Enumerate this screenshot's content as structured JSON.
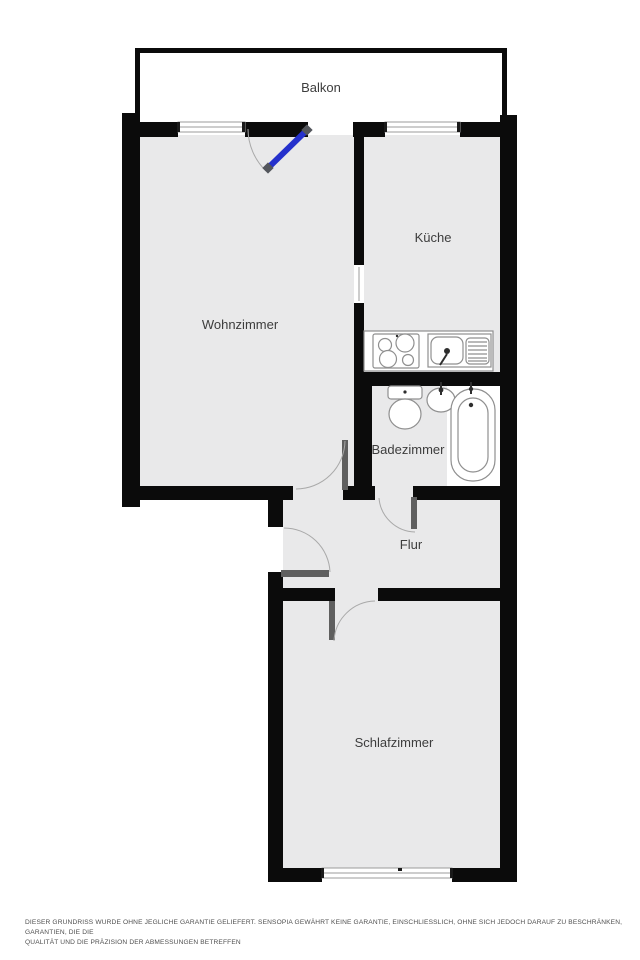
{
  "floor_plan": {
    "title": "Apartment floor plan",
    "rooms": [
      {
        "id": "balkon",
        "label": "Balkon"
      },
      {
        "id": "wohnzimmer",
        "label": "Wohnzimmer"
      },
      {
        "id": "kueche",
        "label": "Küche"
      },
      {
        "id": "badezimmer",
        "label": "Badezimmer"
      },
      {
        "id": "flur",
        "label": "Flur"
      },
      {
        "id": "schlafzimmer",
        "label": "Schlafzimmer"
      }
    ],
    "fixtures": [
      "stove",
      "kitchen-sink",
      "toilet",
      "bathroom-sink",
      "bathtub"
    ],
    "windows": [
      "wohnzimmer-window",
      "kueche-window",
      "schlafzimmer-window"
    ],
    "doors": [
      "balcony-door",
      "wohnzimmer-door",
      "entrance-door",
      "badezimmer-door",
      "schlafzimmer-door"
    ],
    "colors": {
      "wall": "#0b0b0b",
      "room_fill": "#e9e9ea",
      "door_leaf": "#5f5f5f",
      "door_arc": "#a9a9a9",
      "window_stroke": "#9b9b9b",
      "fixture_stroke": "#8f8f8f",
      "balcony_door_blue": "#2531cc",
      "door_cap": "#53565c",
      "label": "#3d3d3d",
      "disclaimer": "#4f4f4f"
    },
    "disclaimer": {
      "line1": "DIESER GRUNDRISS WURDE OHNE JEGLICHE GARANTIE GELIEFERT. SENSOPIA GEWÄHRT KEINE GARANTIE, EINSCHLIESSLICH, OHNE SICH JEDOCH DARAUF ZU BESCHRÄNKEN, GARANTIEN, DIE DIE",
      "line2": "QUALITÄT UND DIE PRÄZISION DER ABMESSUNGEN BETREFFEN"
    }
  }
}
